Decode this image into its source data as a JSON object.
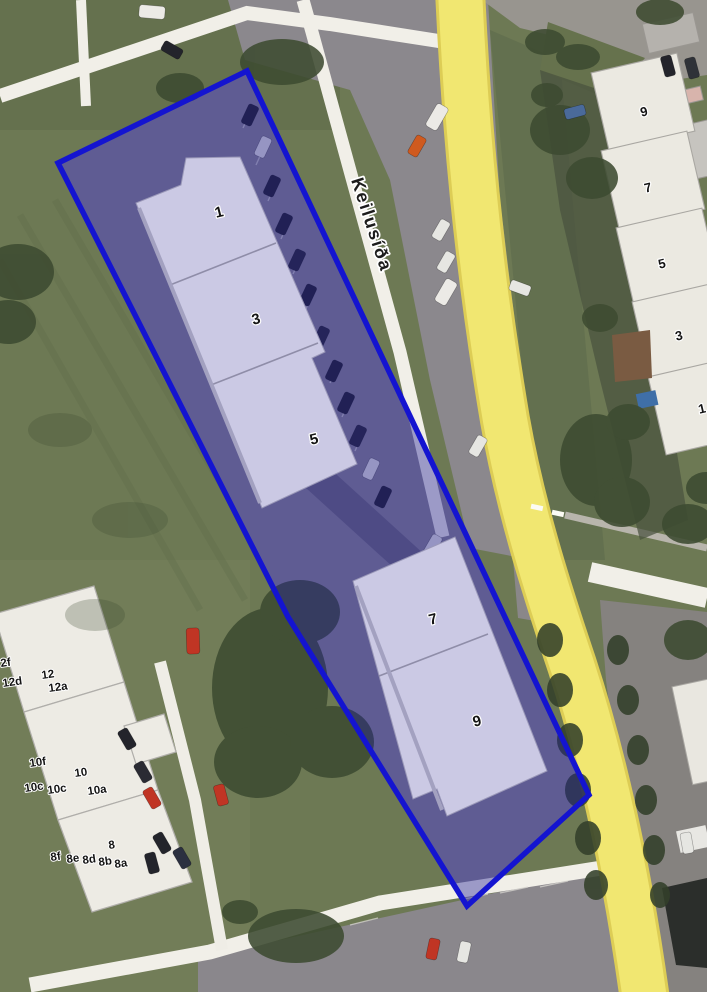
{
  "street": {
    "name": "Keilusíða"
  },
  "parcel": {
    "outline_color": "#1414d0",
    "fill_color": "rgba(30,28,150,0.40)",
    "building_fill": "#cbc9e4",
    "units": [
      {
        "number": "1"
      },
      {
        "number": "3"
      },
      {
        "number": "5"
      },
      {
        "number": "7"
      },
      {
        "number": "9"
      }
    ]
  },
  "east_houses": {
    "numbers": [
      "9",
      "7",
      "5",
      "3",
      "1"
    ]
  },
  "west_houses": {
    "labels": [
      "2f",
      "12d",
      "12",
      "12a",
      "10f",
      "10",
      "10c",
      "10c",
      "10a",
      "8",
      "8f",
      "8e",
      "8d",
      "8b",
      "8a"
    ]
  },
  "colors": {
    "grass": "#6d7954",
    "asphalt": "#8b888d",
    "white_road": "#f1efe8",
    "yellow_road": "#f1e771",
    "neighbor_building": "#edebe4"
  }
}
